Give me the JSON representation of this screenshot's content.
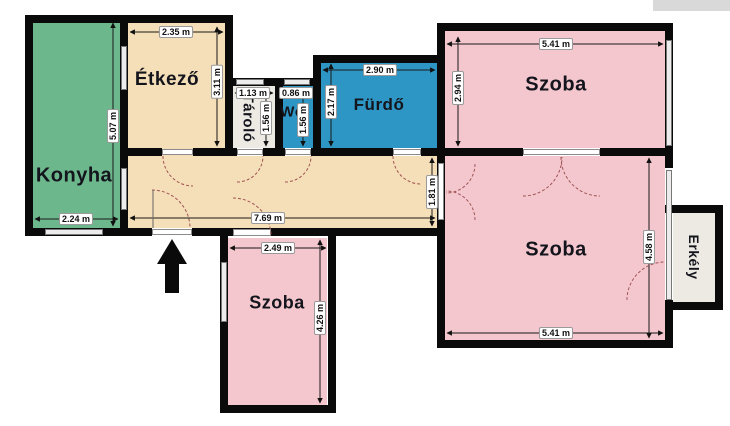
{
  "floorplan": {
    "rooms": {
      "konyha": {
        "label": "Konyha",
        "width_dim": "2.24 m",
        "height_dim": "5.07 m",
        "color": "#6cb78c"
      },
      "etkezo": {
        "label": "Étkező",
        "width_dim": "2.35 m",
        "height_dim": "3.11 m",
        "color": "#f5dfb8"
      },
      "tarolo": {
        "label": "Tároló",
        "width_dim": "1.13 m",
        "height_dim": "1.56 m",
        "color": "#edeae4"
      },
      "wc": {
        "label": "Wc",
        "width_dim": "0.86 m",
        "height_dim": "1.56 m",
        "color": "#2e96c4"
      },
      "furdo": {
        "label": "Fürdő",
        "width_dim": "2.90 m",
        "height_dim": "2.17 m",
        "color": "#2e96c4"
      },
      "szoba_felso": {
        "label": "Szoba",
        "width_dim": "5.41 m",
        "height_dim": "2.94 m",
        "color": "#f4c7ce"
      },
      "szoba_nagy": {
        "label": "Szoba",
        "width_dim": "5.41 m",
        "height_dim": "4.58 m",
        "color": "#f4c7ce"
      },
      "szoba_also": {
        "label": "Szoba",
        "width_dim": "2.49 m",
        "height_dim": "4.26 m",
        "color": "#f4c7ce"
      },
      "erkely": {
        "label": "Erkély",
        "color": "#edeae4"
      }
    },
    "hallway": {
      "width_dim": "7.69 m",
      "height_dim": "1.81 m",
      "color": "#f5dfb8"
    },
    "colors": {
      "wall": "#0a0a0a",
      "door_arc": "#a05555",
      "window": "#ececec",
      "background": "#ffffff",
      "adjacent_structure": "#d9d9d9"
    },
    "entrance_arrow_direction": "up"
  }
}
